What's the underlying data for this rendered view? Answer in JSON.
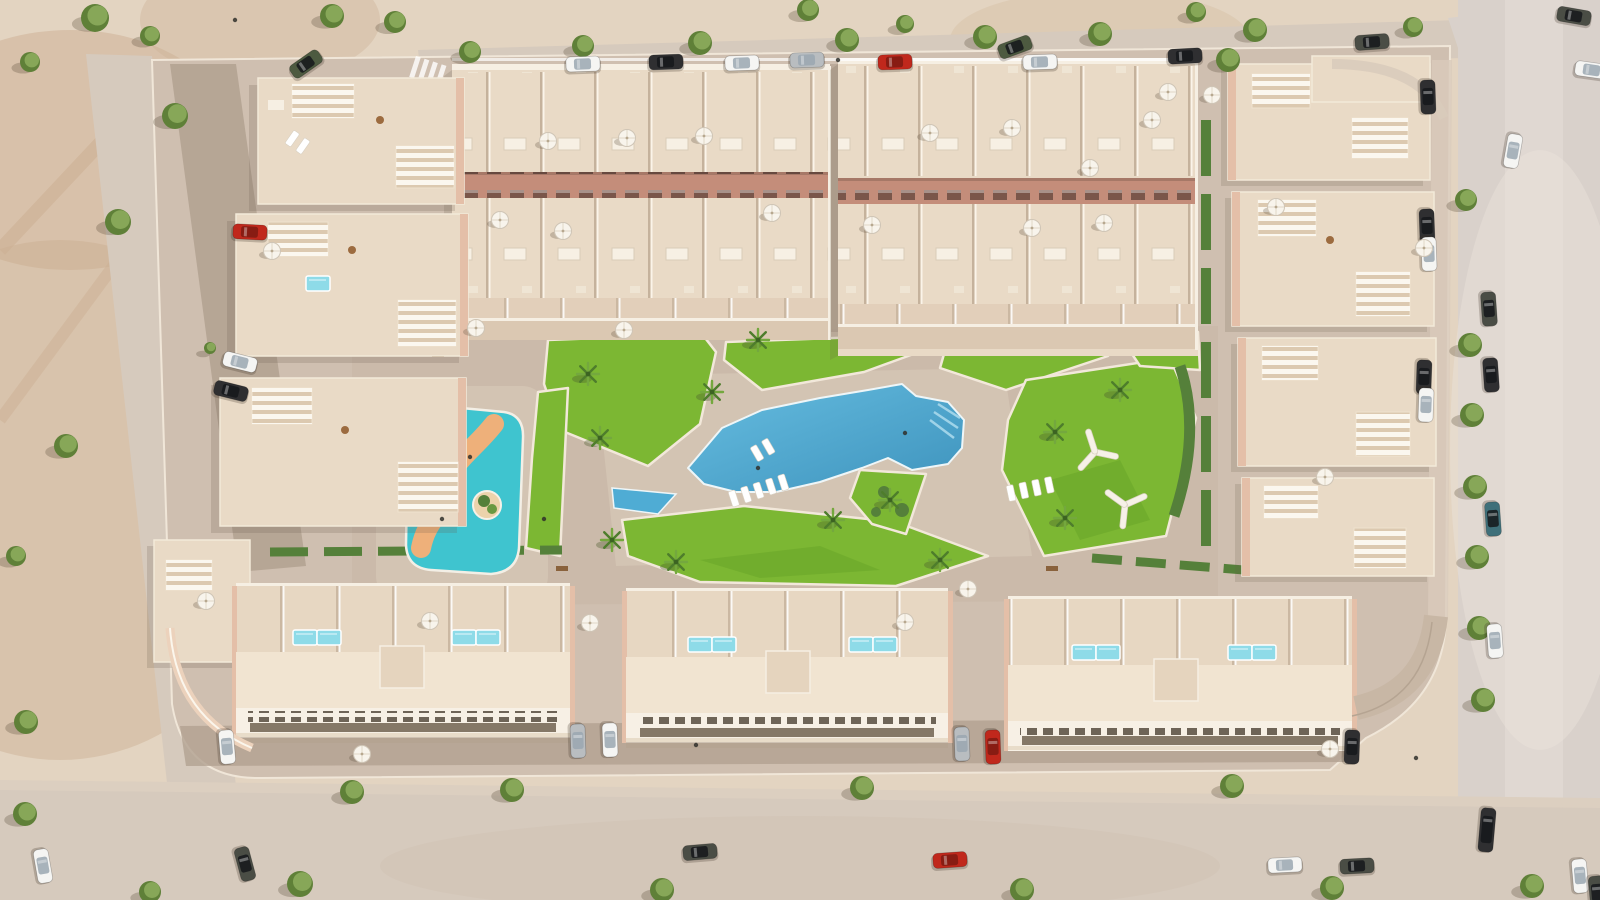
{
  "colors": {
    "sand": "#e3d4c1",
    "sand_dark": "#c9ab8d",
    "road": "#d6cabd",
    "asphalt": "#d9d1cb",
    "pavement": "#cfbfb0",
    "plaza": "#c8b7a7",
    "street": "#b2a191",
    "roof": "#e9dac6",
    "roof_bright": "#f1e4d1",
    "terrace": "#e7d7c2",
    "wall_white": "#f6efe3",
    "facade_pink": "#e4bfa8",
    "facade_rose": "#c48d7a",
    "window_dark": "#6e6457",
    "lawn": "#7cb733",
    "lawn_dark": "#63a226",
    "hedge": "#55803a",
    "tree": "#5f8038",
    "tree_light": "#87a758",
    "pool": "#4facd4",
    "pool_deep": "#3e93bd",
    "kids_pool": "#3fc4cf",
    "river": "#eeb07a",
    "plunge": "#8edbe8",
    "curb": "#f2e8da",
    "parasol": "#f8f4ec",
    "car_white": "#f5f5f3",
    "car_black": "#2f2f31",
    "car_red": "#c0281c",
    "car_silver": "#b9bdc0",
    "car_dark": "#4a4d45",
    "car_teal": "#3f707a",
    "car_green": "#4d5a40"
  },
  "scene": {
    "trees": [
      [
        95,
        18,
        14
      ],
      [
        30,
        62,
        10
      ],
      [
        332,
        16,
        12
      ],
      [
        150,
        36,
        10
      ],
      [
        395,
        22,
        11
      ],
      [
        470,
        52,
        11
      ],
      [
        583,
        46,
        11
      ],
      [
        700,
        43,
        12
      ],
      [
        847,
        40,
        12
      ],
      [
        985,
        37,
        12
      ],
      [
        1100,
        34,
        12
      ],
      [
        1255,
        30,
        12
      ],
      [
        1413,
        27,
        10
      ],
      [
        905,
        24,
        9
      ],
      [
        1228,
        60,
        12
      ],
      [
        808,
        10,
        11
      ],
      [
        1196,
        12,
        10
      ],
      [
        175,
        116,
        13
      ],
      [
        118,
        222,
        13
      ],
      [
        66,
        446,
        12
      ],
      [
        16,
        556,
        10
      ],
      [
        26,
        722,
        12
      ],
      [
        210,
        348,
        6
      ],
      [
        1466,
        200,
        11
      ],
      [
        1470,
        345,
        12
      ],
      [
        1472,
        415,
        12
      ],
      [
        1475,
        487,
        12
      ],
      [
        1477,
        557,
        12
      ],
      [
        1479,
        628,
        12
      ],
      [
        1483,
        700,
        12
      ],
      [
        352,
        792,
        12
      ],
      [
        512,
        790,
        12
      ],
      [
        862,
        788,
        12
      ],
      [
        1232,
        786,
        12
      ],
      [
        300,
        884,
        13
      ],
      [
        25,
        814,
        12
      ],
      [
        662,
        890,
        12
      ],
      [
        1022,
        890,
        12
      ],
      [
        1332,
        888,
        12
      ],
      [
        1532,
        886,
        12
      ],
      [
        150,
        892,
        11
      ]
    ],
    "palms": [
      [
        600,
        438
      ],
      [
        612,
        540
      ],
      [
        712,
        392
      ],
      [
        833,
        520
      ],
      [
        1055,
        432
      ],
      [
        1065,
        518
      ],
      [
        890,
        500
      ],
      [
        676,
        562
      ],
      [
        940,
        560
      ],
      [
        588,
        374
      ],
      [
        758,
        340
      ],
      [
        1120,
        390
      ]
    ],
    "cars": [
      [
        583,
        64,
        -2,
        "white"
      ],
      [
        666,
        62,
        -2,
        "black"
      ],
      [
        742,
        63,
        -2,
        "white"
      ],
      [
        807,
        60,
        -2,
        "silver"
      ],
      [
        895,
        62,
        -2,
        "red"
      ],
      [
        1015,
        47,
        -20,
        "green"
      ],
      [
        1040,
        62,
        -2,
        "white"
      ],
      [
        1185,
        56,
        -3,
        "black"
      ],
      [
        1372,
        42,
        -4,
        "dark"
      ],
      [
        306,
        64,
        -35,
        "green"
      ],
      [
        250,
        232,
        3,
        "red"
      ],
      [
        240,
        362,
        14,
        "white"
      ],
      [
        231,
        391,
        14,
        "black"
      ],
      [
        1428,
        97,
        88,
        "black"
      ],
      [
        1427,
        226,
        88,
        "black"
      ],
      [
        1429,
        254,
        88,
        "white"
      ],
      [
        1424,
        377,
        92,
        "black"
      ],
      [
        1426,
        405,
        92,
        "white"
      ],
      [
        1489,
        309,
        86,
        "dark"
      ],
      [
        1491,
        375,
        86,
        "black"
      ],
      [
        1493,
        519,
        86,
        "teal"
      ],
      [
        1495,
        641,
        86,
        "white"
      ],
      [
        1574,
        16,
        10,
        "dark"
      ],
      [
        1592,
        70,
        8,
        "white"
      ],
      [
        1513,
        151,
        100,
        "white"
      ],
      [
        227,
        747,
        85,
        "white"
      ],
      [
        578,
        741,
        88,
        "silver"
      ],
      [
        610,
        740,
        88,
        "white"
      ],
      [
        962,
        744,
        88,
        "silver"
      ],
      [
        993,
        747,
        88,
        "red"
      ],
      [
        1352,
        747,
        92,
        "black"
      ],
      [
        43,
        866,
        80,
        "white"
      ],
      [
        245,
        864,
        75,
        "dark"
      ],
      [
        700,
        852,
        -5,
        "dark"
      ],
      [
        950,
        860,
        -4,
        "red"
      ],
      [
        1285,
        865,
        -3,
        "white"
      ],
      [
        1357,
        866,
        -3,
        "dark"
      ],
      [
        1487,
        830,
        95,
        "black",
        44
      ],
      [
        1580,
        876,
        85,
        "white"
      ],
      [
        1597,
        893,
        85,
        "dark"
      ]
    ],
    "parasols": [
      [
        548,
        141
      ],
      [
        627,
        138
      ],
      [
        704,
        136
      ],
      [
        500,
        220
      ],
      [
        563,
        231
      ],
      [
        772,
        213
      ],
      [
        930,
        133
      ],
      [
        1012,
        128
      ],
      [
        1090,
        168
      ],
      [
        1152,
        120
      ],
      [
        872,
        225
      ],
      [
        1032,
        228
      ],
      [
        1104,
        223
      ],
      [
        1168,
        92
      ],
      [
        476,
        328
      ],
      [
        624,
        330
      ],
      [
        272,
        251
      ],
      [
        206,
        601
      ],
      [
        1212,
        95
      ],
      [
        1276,
        207
      ],
      [
        1325,
        477
      ],
      [
        1424,
        248
      ],
      [
        430,
        621
      ],
      [
        590,
        623
      ],
      [
        362,
        754
      ],
      [
        905,
        622
      ],
      [
        968,
        589
      ],
      [
        1330,
        749
      ]
    ],
    "plunge_pools": [
      [
        293,
        630
      ],
      [
        317,
        630
      ],
      [
        452,
        630
      ],
      [
        476,
        630
      ],
      [
        688,
        637
      ],
      [
        712,
        637
      ],
      [
        849,
        637
      ],
      [
        873,
        637
      ],
      [
        1072,
        645
      ],
      [
        1096,
        645
      ],
      [
        1228,
        645
      ],
      [
        1252,
        645
      ],
      [
        306,
        276
      ]
    ],
    "lounger_rows": [
      {
        "x": 728,
        "y": 492,
        "rot": -18,
        "n": 5
      },
      {
        "x": 1006,
        "y": 486,
        "rot": -12,
        "n": 4
      },
      {
        "x": 750,
        "y": 448,
        "rot": -30,
        "n": 2
      },
      {
        "x": 294,
        "y": 130,
        "rot": 35,
        "n": 2
      }
    ],
    "people": [
      [
        544,
        519
      ],
      [
        758,
        468
      ],
      [
        905,
        433
      ],
      [
        470,
        457
      ],
      [
        442,
        519
      ],
      [
        838,
        60
      ],
      [
        696,
        745
      ],
      [
        1416,
        758
      ],
      [
        235,
        20
      ]
    ]
  }
}
